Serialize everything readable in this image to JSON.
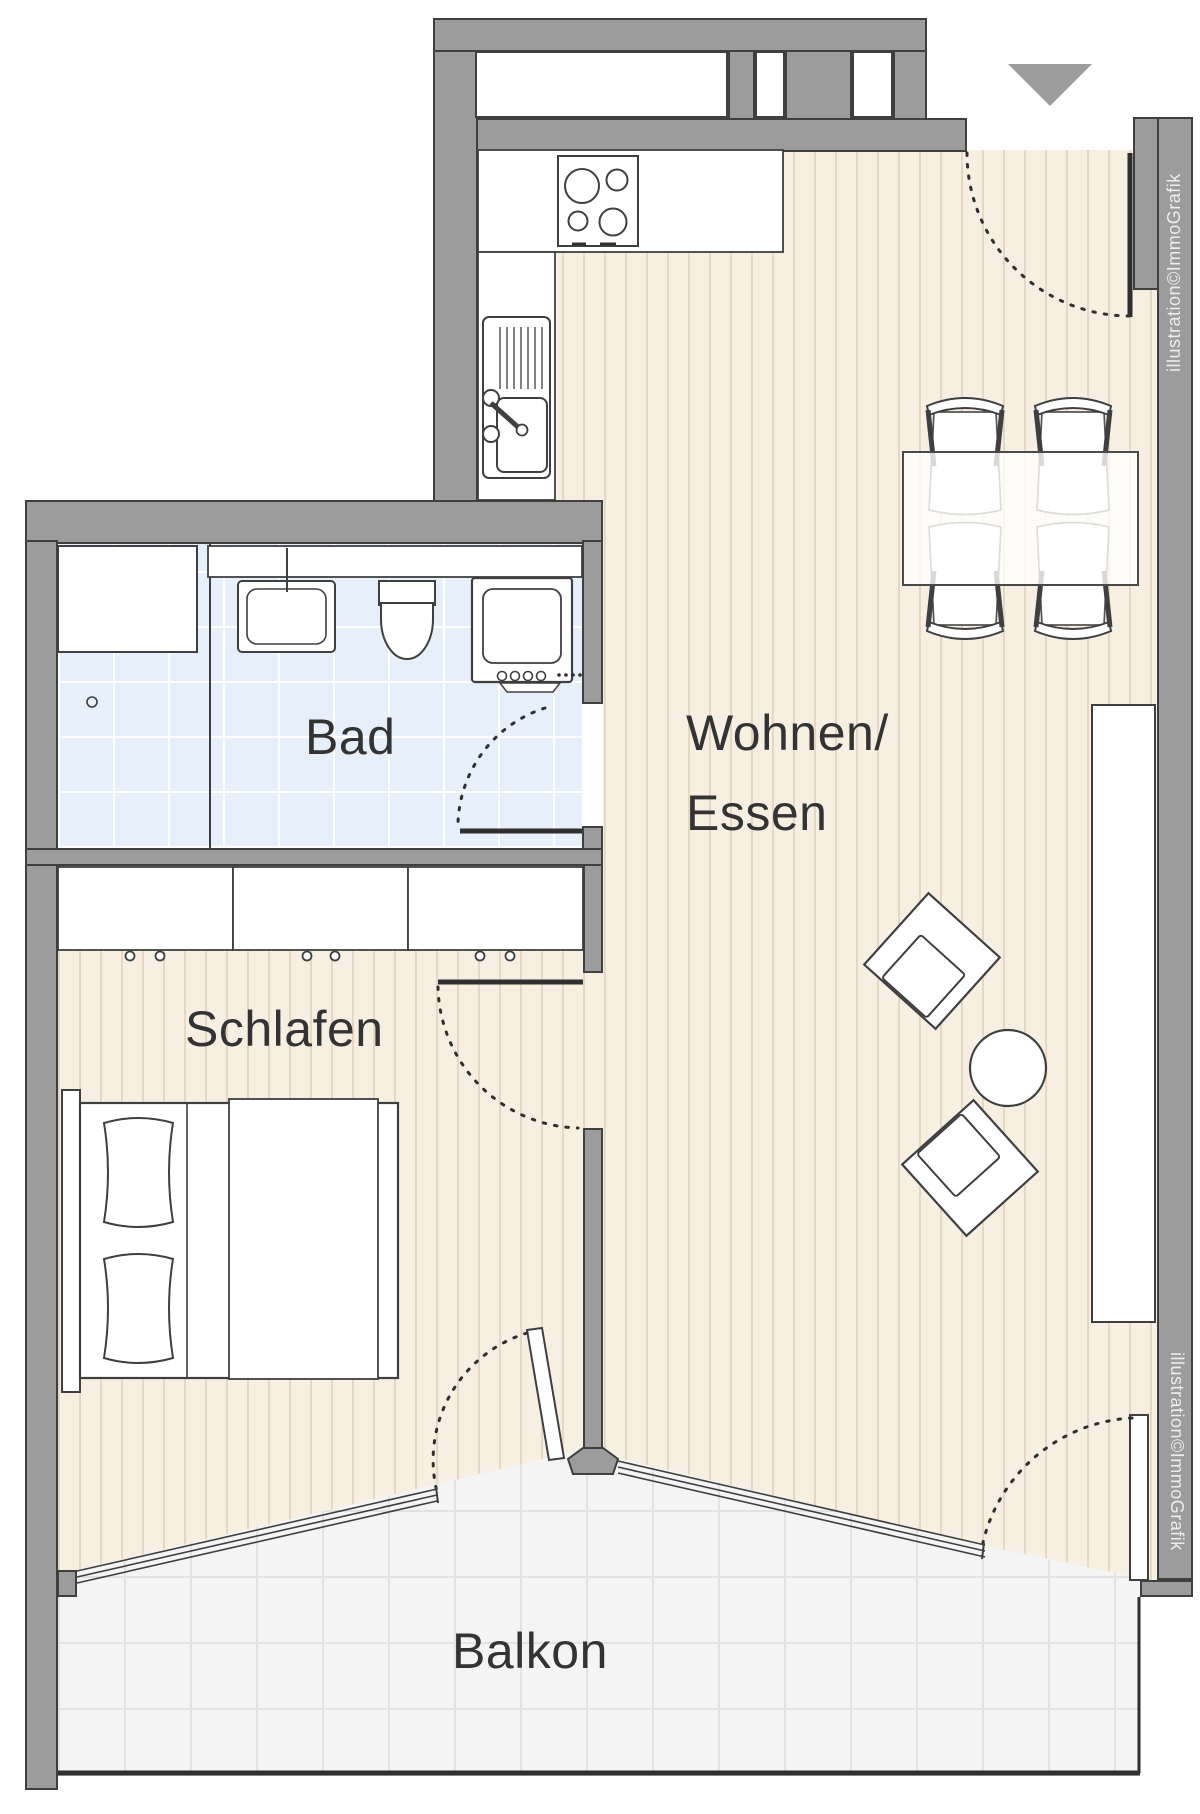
{
  "title": "Apartment floor plan",
  "rooms": {
    "bath": "Bad",
    "living_line1": "Wohnen/",
    "living_line2": "Essen",
    "bedroom": "Schlafen",
    "balcony": "Balkon"
  },
  "watermark": {
    "text": "illustration©ImmoGrafik"
  },
  "icons": {
    "entrance_marker": "triangle-down-icon"
  },
  "colors": {
    "wall": "#9c9c9c",
    "wall_outline": "#3f3f3f",
    "wood_floor": "#f7efe2",
    "bath_tile": "#e6effa",
    "balcony_tile": "#f4f4f4",
    "drawing_line": "#2f2f2f"
  }
}
